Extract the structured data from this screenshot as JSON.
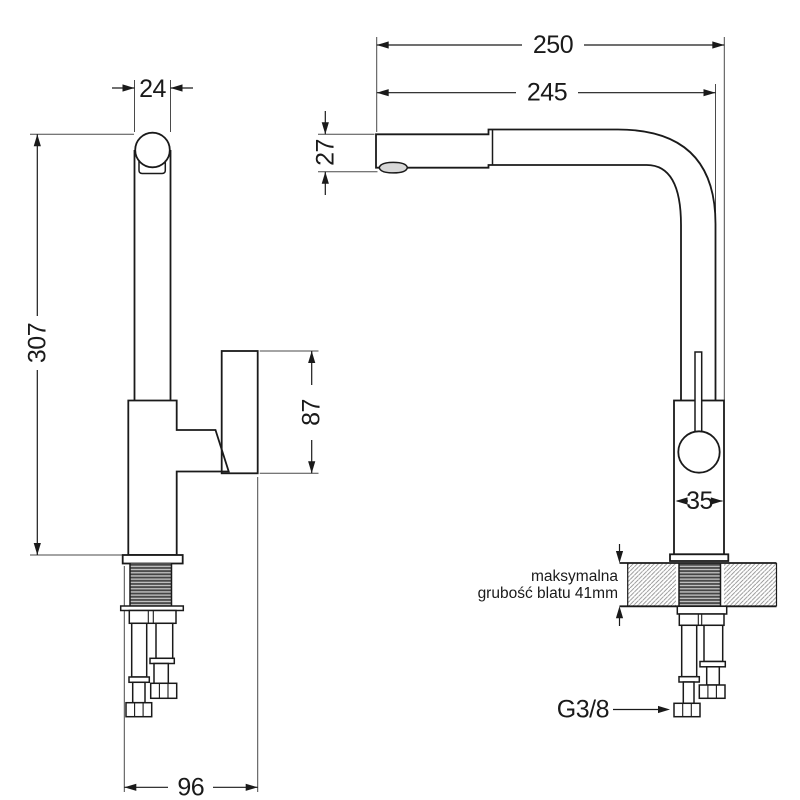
{
  "drawing": {
    "background": "#ffffff",
    "line_color": "#1a1a1a",
    "side_view": {
      "spout_width": "24",
      "total_height": "307",
      "handle_height": "87",
      "base_depth": "96"
    },
    "front_view": {
      "total_reach": "250",
      "spout_reach": "245",
      "spout_height": "27",
      "body_width": "35",
      "connection_thread": "G3/8",
      "note_line1": "maksymalna",
      "note_line2": "grubość blatu 41mm"
    }
  }
}
